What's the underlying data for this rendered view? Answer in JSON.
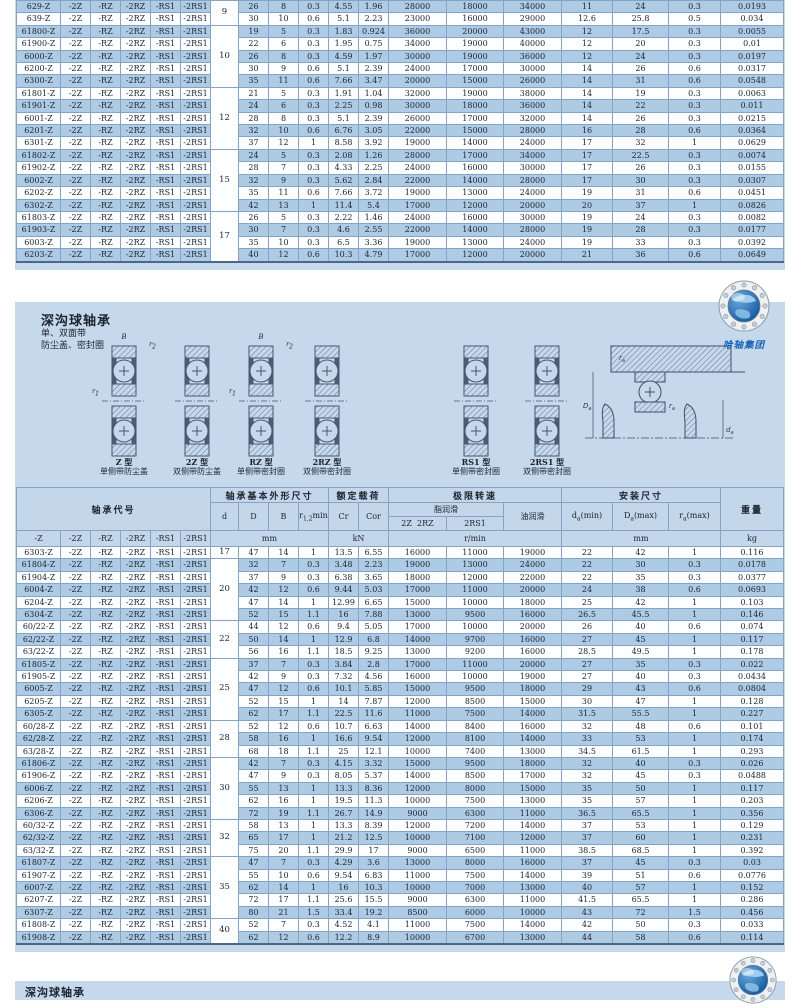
{
  "colors": {
    "page_bg": "#c6d8eb",
    "row_highlight": "#aecbe5",
    "header_bg": "#c3d6ea",
    "logo_text_blue": "#1663b5"
  },
  "logo": {
    "company": "哈轴集团"
  },
  "page2": {
    "title": "深沟球轴承",
    "subtitle_line1": "单、双面带",
    "subtitle_line2": "防尘盖、密封圈",
    "dim_B": "B",
    "dim_r1": {
      "base": "r",
      "sub": "1"
    },
    "dim_r2": {
      "base": "r",
      "sub": "2"
    },
    "types": [
      {
        "name": "Z 型",
        "desc": "单侧带防尘盖",
        "dims": true
      },
      {
        "name": "2Z 型",
        "desc": "双侧带防尘盖",
        "dims": false
      },
      {
        "name": "RZ 型",
        "desc": "单侧带密封圈",
        "dims": true
      },
      {
        "name": "2RZ 型",
        "desc": "双侧带密封圈",
        "dims": false
      },
      {
        "name": "RS1 型",
        "desc": "单侧带密封圈",
        "dims": false
      },
      {
        "name": "2RS1 型",
        "desc": "双侧带密封圈",
        "dims": false
      }
    ],
    "mount": {
      "ra": {
        "base": "r",
        "sub": "a"
      },
      "Da": {
        "base": "D",
        "sub": "a"
      },
      "da": {
        "base": "d",
        "sub": "a"
      }
    }
  },
  "page3": {
    "title": "深沟球轴承"
  },
  "header": {
    "code_group": "轴承代号",
    "dims_group": "轴承基本外形尺寸",
    "load_group": "额定载荷",
    "speed_group": "极限转速",
    "mount_group": "安装尺寸",
    "weight_group": "重量",
    "d": "d",
    "D": "D",
    "B": "B",
    "r": {
      "base": "r",
      "sub": "1,2",
      "rest": "min"
    },
    "cr": "Cr",
    "cor": "Cor",
    "grease": "脂润滑",
    "oil": "油润滑",
    "g2z2rz": "2Z  2RZ",
    "g2rs1": "2RS1",
    "suffix_headers": [
      "-Z",
      "-2Z",
      "-RZ",
      "-2RZ",
      "-RS1",
      "-2RS1"
    ],
    "da": {
      "base": "d",
      "sub": "a",
      "rest": "(min)"
    },
    "Da": {
      "base": "D",
      "sub": "a",
      "rest": "(max)"
    },
    "ra": {
      "base": "r",
      "sub": "a",
      "rest": "(max)"
    },
    "mm": "mm",
    "kn": "kN",
    "rpm": "r/min",
    "kg": "kg"
  },
  "suffixes": [
    "-2Z",
    "-RZ",
    "-2RZ",
    "-RS1",
    "-2RS1"
  ],
  "table1": {
    "rows": [
      {
        "c": "629-Z",
        "d": "9",
        "ds": 2,
        "v": [
          "26",
          "8",
          "0.3",
          "4.55",
          "1.96",
          "28000",
          "18000",
          "34000",
          "11",
          "24",
          "0.3",
          "0.0193"
        ]
      },
      {
        "c": "639-Z",
        "v": [
          "30",
          "10",
          "0.6",
          "5.1",
          "2.23",
          "23000",
          "16000",
          "29000",
          "12.6",
          "25.8",
          "0.5",
          "0.034"
        ]
      },
      {
        "c": "61800-Z",
        "d": "10",
        "ds": 5,
        "v": [
          "19",
          "5",
          "0.3",
          "1.83",
          "0.924",
          "36000",
          "20000",
          "43000",
          "12",
          "17.5",
          "0.3",
          "0.0055"
        ]
      },
      {
        "c": "61900-Z",
        "v": [
          "22",
          "6",
          "0.3",
          "1.95",
          "0.75",
          "34000",
          "19000",
          "40000",
          "12",
          "20",
          "0.3",
          "0.01"
        ]
      },
      {
        "c": "6000-Z",
        "v": [
          "26",
          "8",
          "0.3",
          "4.59",
          "1.97",
          "30000",
          "19000",
          "36000",
          "12",
          "24",
          "0.3",
          "0.0197"
        ]
      },
      {
        "c": "6200-Z",
        "v": [
          "30",
          "9",
          "0.6",
          "5.1",
          "2.39",
          "24000",
          "17000",
          "30000",
          "14",
          "26",
          "0.6",
          "0.0317"
        ]
      },
      {
        "c": "6300-Z",
        "v": [
          "35",
          "11",
          "0.6",
          "7.66",
          "3.47",
          "20000",
          "15000",
          "26000",
          "14",
          "31",
          "0.6",
          "0.0548"
        ]
      },
      {
        "c": "61801-Z",
        "d": "12",
        "ds": 5,
        "v": [
          "21",
          "5",
          "0.3",
          "1.91",
          "1.04",
          "32000",
          "19000",
          "38000",
          "14",
          "19",
          "0.3",
          "0.0063"
        ]
      },
      {
        "c": "61901-Z",
        "v": [
          "24",
          "6",
          "0.3",
          "2.25",
          "0.98",
          "30000",
          "18000",
          "36000",
          "14",
          "22",
          "0.3",
          "0.011"
        ]
      },
      {
        "c": "6001-Z",
        "v": [
          "28",
          "8",
          "0.3",
          "5.1",
          "2.39",
          "26000",
          "17000",
          "32000",
          "14",
          "26",
          "0.3",
          "0.0215"
        ]
      },
      {
        "c": "6201-Z",
        "v": [
          "32",
          "10",
          "0.6",
          "6.76",
          "3.05",
          "22000",
          "15000",
          "28000",
          "16",
          "28",
          "0.6",
          "0.0364"
        ]
      },
      {
        "c": "6301-Z",
        "v": [
          "37",
          "12",
          "1",
          "8.58",
          "3.92",
          "19000",
          "14000",
          "24000",
          "17",
          "32",
          "1",
          "0.0629"
        ]
      },
      {
        "c": "61802-Z",
        "d": "15",
        "ds": 5,
        "v": [
          "24",
          "5",
          "0.3",
          "2.08",
          "1.26",
          "28000",
          "17000",
          "34000",
          "17",
          "22.5",
          "0.3",
          "0.0074"
        ]
      },
      {
        "c": "61902-Z",
        "v": [
          "28",
          "7",
          "0.3",
          "4.33",
          "2.25",
          "24000",
          "16000",
          "30000",
          "17",
          "26",
          "0.3",
          "0.0155"
        ]
      },
      {
        "c": "6002-Z",
        "v": [
          "32",
          "9",
          "0.3",
          "5.62",
          "2.84",
          "22000",
          "14000",
          "28000",
          "17",
          "30",
          "0.3",
          "0.0307"
        ]
      },
      {
        "c": "6202-Z",
        "v": [
          "35",
          "11",
          "0.6",
          "7.66",
          "3.72",
          "19000",
          "13000",
          "24000",
          "19",
          "31",
          "0.6",
          "0.0451"
        ]
      },
      {
        "c": "6302-Z",
        "v": [
          "42",
          "13",
          "1",
          "11.4",
          "5.4",
          "17000",
          "12000",
          "20000",
          "20",
          "37",
          "1",
          "0.0826"
        ]
      },
      {
        "c": "61803-Z",
        "d": "17",
        "ds": 4,
        "v": [
          "26",
          "5",
          "0.3",
          "2.22",
          "1.46",
          "24000",
          "16000",
          "30000",
          "19",
          "24",
          "0.3",
          "0.0082"
        ]
      },
      {
        "c": "61903-Z",
        "v": [
          "30",
          "7",
          "0.3",
          "4.6",
          "2.55",
          "22000",
          "14000",
          "28000",
          "19",
          "28",
          "0.3",
          "0.0177"
        ]
      },
      {
        "c": "6003-Z",
        "v": [
          "35",
          "10",
          "0.3",
          "6.5",
          "3.36",
          "19000",
          "13000",
          "24000",
          "19",
          "33",
          "0.3",
          "0.0392"
        ]
      },
      {
        "c": "6203-Z",
        "v": [
          "40",
          "12",
          "0.6",
          "10.3",
          "4.79",
          "17000",
          "12000",
          "20000",
          "21",
          "36",
          "0.6",
          "0.0649"
        ]
      }
    ]
  },
  "table2": {
    "rows": [
      {
        "c": "6303-Z",
        "d": "17",
        "ds": 1,
        "v": [
          "47",
          "14",
          "1",
          "13.5",
          "6.55",
          "16000",
          "11000",
          "19000",
          "22",
          "42",
          "1",
          "0.116"
        ]
      },
      {
        "c": "61804-Z",
        "d": "20",
        "ds": 5,
        "v": [
          "32",
          "7",
          "0.3",
          "3.48",
          "2.23",
          "19000",
          "13000",
          "24000",
          "22",
          "30",
          "0.3",
          "0.0178"
        ]
      },
      {
        "c": "61904-Z",
        "v": [
          "37",
          "9",
          "0.3",
          "6.38",
          "3.65",
          "18000",
          "12000",
          "22000",
          "22",
          "35",
          "0.3",
          "0.0377"
        ]
      },
      {
        "c": "6004-Z",
        "v": [
          "42",
          "12",
          "0.6",
          "9.44",
          "5.03",
          "17000",
          "11000",
          "20000",
          "24",
          "38",
          "0.6",
          "0.0693"
        ]
      },
      {
        "c": "6204-Z",
        "v": [
          "47",
          "14",
          "1",
          "12.99",
          "6.65",
          "15000",
          "10000",
          "18000",
          "25",
          "42",
          "1",
          "0.103"
        ]
      },
      {
        "c": "6304-Z",
        "v": [
          "52",
          "15",
          "1.1",
          "16",
          "7.88",
          "13000",
          "9500",
          "16000",
          "26.5",
          "45.5",
          "1",
          "0.146"
        ]
      },
      {
        "c": "60/22-Z",
        "d": "22",
        "ds": 3,
        "v": [
          "44",
          "12",
          "0.6",
          "9.4",
          "5.05",
          "17000",
          "10000",
          "20000",
          "26",
          "40",
          "0.6",
          "0.074"
        ]
      },
      {
        "c": "62/22-Z",
        "v": [
          "50",
          "14",
          "1",
          "12.9",
          "6.8",
          "14000",
          "9700",
          "16000",
          "27",
          "45",
          "1",
          "0.117"
        ]
      },
      {
        "c": "63/22-Z",
        "v": [
          "56",
          "16",
          "1.1",
          "18.5",
          "9.25",
          "13000",
          "9200",
          "16000",
          "28.5",
          "49.5",
          "1",
          "0.178"
        ]
      },
      {
        "c": "61805-Z",
        "d": "25",
        "ds": 5,
        "v": [
          "37",
          "7",
          "0.3",
          "3.84",
          "2.8",
          "17000",
          "11000",
          "20000",
          "27",
          "35",
          "0.3",
          "0.022"
        ]
      },
      {
        "c": "61905-Z",
        "v": [
          "42",
          "9",
          "0.3",
          "7.32",
          "4.56",
          "16000",
          "10000",
          "19000",
          "27",
          "40",
          "0.3",
          "0.0434"
        ]
      },
      {
        "c": "6005-Z",
        "v": [
          "47",
          "12",
          "0.6",
          "10.1",
          "5.85",
          "15000",
          "9500",
          "18000",
          "29",
          "43",
          "0.6",
          "0.0804"
        ]
      },
      {
        "c": "6205-Z",
        "v": [
          "52",
          "15",
          "1",
          "14",
          "7.87",
          "12000",
          "8500",
          "15000",
          "30",
          "47",
          "1",
          "0.128"
        ]
      },
      {
        "c": "6305-Z",
        "v": [
          "62",
          "17",
          "1.1",
          "22.5",
          "11.6",
          "11000",
          "7500",
          "14000",
          "31.5",
          "55.5",
          "1",
          "0.227"
        ]
      },
      {
        "c": "60/28-Z",
        "d": "28",
        "ds": 3,
        "v": [
          "52",
          "12",
          "0.6",
          "10.7",
          "6.63",
          "14000",
          "8400",
          "16000",
          "32",
          "48",
          "0.6",
          "0.101"
        ]
      },
      {
        "c": "62/28-Z",
        "v": [
          "58",
          "16",
          "1",
          "16.6",
          "9.54",
          "12000",
          "8100",
          "14000",
          "33",
          "53",
          "1",
          "0.174"
        ]
      },
      {
        "c": "63/28-Z",
        "v": [
          "68",
          "18",
          "1.1",
          "25",
          "12.1",
          "10000",
          "7400",
          "13000",
          "34.5",
          "61.5",
          "1",
          "0.293"
        ]
      },
      {
        "c": "61806-Z",
        "d": "30",
        "ds": 5,
        "v": [
          "42",
          "7",
          "0.3",
          "4.15",
          "3.32",
          "15000",
          "9500",
          "18000",
          "32",
          "40",
          "0.3",
          "0.026"
        ]
      },
      {
        "c": "61906-Z",
        "v": [
          "47",
          "9",
          "0.3",
          "8.05",
          "5.37",
          "14000",
          "8500",
          "17000",
          "32",
          "45",
          "0.3",
          "0.0488"
        ]
      },
      {
        "c": "6006-Z",
        "v": [
          "55",
          "13",
          "1",
          "13.3",
          "8.36",
          "12000",
          "8000",
          "15000",
          "35",
          "50",
          "1",
          "0.117"
        ]
      },
      {
        "c": "6206-Z",
        "v": [
          "62",
          "16",
          "1",
          "19.5",
          "11.3",
          "10000",
          "7500",
          "13000",
          "35",
          "57",
          "1",
          "0.203"
        ]
      },
      {
        "c": "6306-Z",
        "v": [
          "72",
          "19",
          "1.1",
          "26.7",
          "14.9",
          "9000",
          "6300",
          "11000",
          "36.5",
          "65.5",
          "1",
          "0.356"
        ]
      },
      {
        "c": "60/32-Z",
        "d": "32",
        "ds": 3,
        "v": [
          "58",
          "13",
          "1",
          "13.3",
          "8.39",
          "12000",
          "7200",
          "14000",
          "37",
          "53",
          "1",
          "0.129"
        ]
      },
      {
        "c": "62/32-Z",
        "v": [
          "65",
          "17",
          "1",
          "21.2",
          "12.5",
          "10000",
          "7100",
          "12000",
          "37",
          "60",
          "1",
          "0.231"
        ]
      },
      {
        "c": "63/32-Z",
        "v": [
          "75",
          "20",
          "1.1",
          "29.9",
          "17",
          "9000",
          "6500",
          "11000",
          "38.5",
          "68.5",
          "1",
          "0.392"
        ]
      },
      {
        "c": "61807-Z",
        "d": "35",
        "ds": 5,
        "v": [
          "47",
          "7",
          "0.3",
          "4.29",
          "3.6",
          "13000",
          "8000",
          "16000",
          "37",
          "45",
          "0.3",
          "0.03"
        ]
      },
      {
        "c": "61907-Z",
        "v": [
          "55",
          "10",
          "0.6",
          "9.54",
          "6.83",
          "11000",
          "7500",
          "14000",
          "39",
          "51",
          "0.6",
          "0.0776"
        ]
      },
      {
        "c": "6007-Z",
        "v": [
          "62",
          "14",
          "1",
          "16",
          "10.3",
          "10000",
          "7000",
          "13000",
          "40",
          "57",
          "1",
          "0.152"
        ]
      },
      {
        "c": "6207-Z",
        "v": [
          "72",
          "17",
          "1.1",
          "25.6",
          "15.5",
          "9000",
          "6300",
          "11000",
          "41.5",
          "65.5",
          "1",
          "0.286"
        ]
      },
      {
        "c": "6307-Z",
        "v": [
          "80",
          "21",
          "1.5",
          "33.4",
          "19.2",
          "8500",
          "6000",
          "10000",
          "43",
          "72",
          "1.5",
          "0.456"
        ]
      },
      {
        "c": "61808-Z",
        "d": "40",
        "ds": 2,
        "v": [
          "52",
          "7",
          "0.3",
          "4.52",
          "4.1",
          "11000",
          "7500",
          "14000",
          "42",
          "50",
          "0.3",
          "0.033"
        ]
      },
      {
        "c": "61908-Z",
        "v": [
          "62",
          "12",
          "0.6",
          "12.2",
          "8.9",
          "10000",
          "6700",
          "13000",
          "44",
          "58",
          "0.6",
          "0.114"
        ]
      }
    ]
  }
}
